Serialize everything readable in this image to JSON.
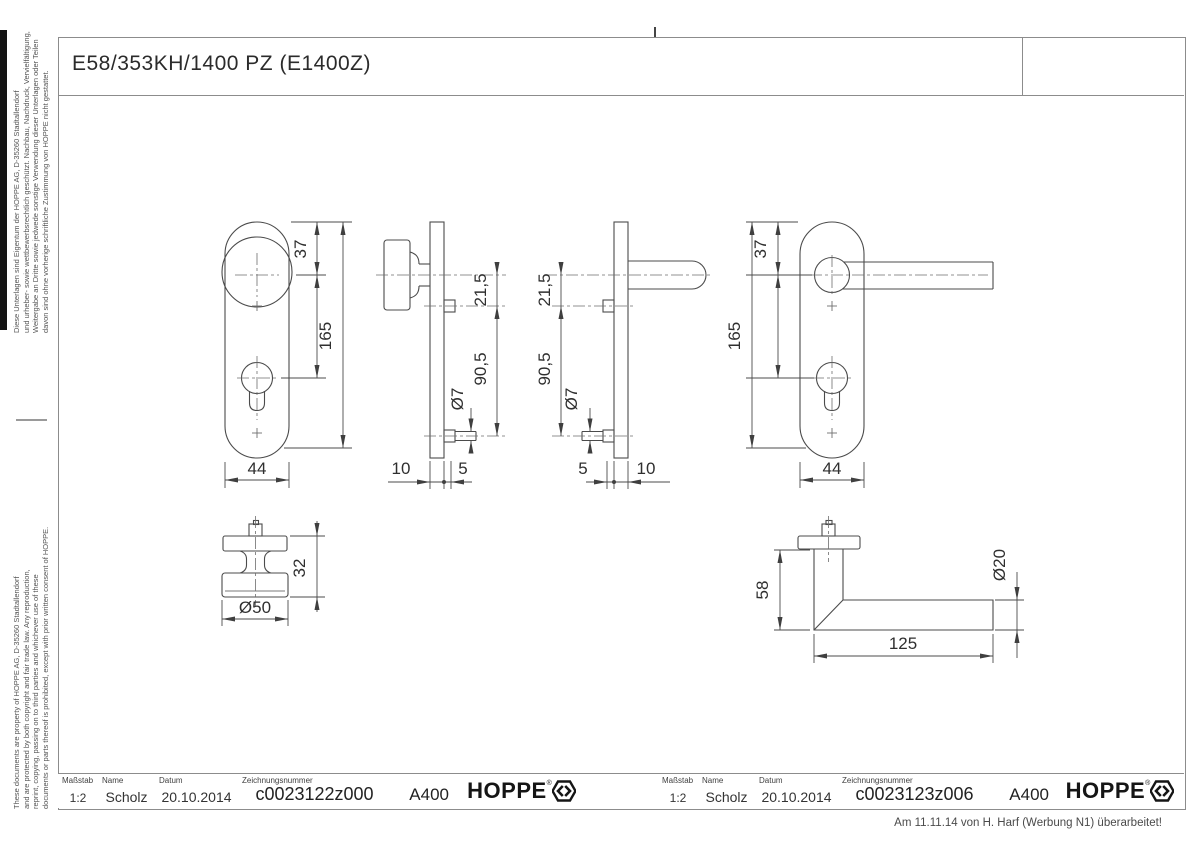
{
  "drawing_title": "E58/353KH/1400 PZ (E1400Z)",
  "legal_notice": {
    "german": [
      "Diese Unterlagen sind Eigentum der HOPPE AG, D-35260 Stadtallendorf",
      "und urheber- sowie wettbewerbsrechtlich geschützt. Nachbau, Nachdruck, Vervielfältigung,",
      "Weitergabe an Dritte sowie jedwede sonstige Verwendung dieser Unterlagen oder Teilen",
      "davon sind ohne vorherige schriftliche Zustimmung von HOPPE nicht gestattet."
    ],
    "english": [
      "These documents are property of HOPPE AG, D-35260 Stadtallendorf",
      "and are protected by both copyright and fair trade law. Any reproduction,",
      "reprint, copying, passing on to third parties and whichever use of these",
      "documents or parts thereof is prohibited, except with prior written consent of HOPPE."
    ]
  },
  "dimensions": {
    "knob_front": {
      "offset_top": "37",
      "length": "165",
      "width": "44"
    },
    "knob_side": {
      "axis_to_hole": "21,5",
      "hole_spacing": "90,5",
      "hole_dia": "Ø7",
      "knob_depth": "10",
      "nut_depth": "5"
    },
    "lever_side": {
      "axis_to_hole": "21,5",
      "hole_spacing": "90,5",
      "hole_dia": "Ø7",
      "nut_depth": "5",
      "plate_depth": "10"
    },
    "lever_front": {
      "offset_top": "37",
      "length": "165",
      "width": "44"
    },
    "knob_detail": {
      "height": "32",
      "diameter": "Ø50"
    },
    "lever_detail": {
      "height": "58",
      "grip_dia": "Ø20",
      "grip_length": "125"
    }
  },
  "title_blocks": [
    {
      "scale_label": "Maßstab",
      "scale": "1:2",
      "name_label": "Name",
      "name": "Scholz",
      "date_label": "Datum",
      "date": "20.10.2014",
      "number_label": "Zeichnungsnummer",
      "number": "c0023122z000",
      "code": "A400",
      "brand": "HOPPE",
      "reg": "®"
    },
    {
      "scale_label": "Maßstab",
      "scale": "1:2",
      "name_label": "Name",
      "name": "Scholz",
      "date_label": "Datum",
      "date": "20.10.2014",
      "number_label": "Zeichnungsnummer",
      "number": "c0023123z006",
      "code": "A400",
      "brand": "HOPPE",
      "reg": "®"
    }
  ],
  "revision_note": "Am 11.11.14 von H. Harf (Werbung N1) überarbeitet!",
  "colors": {
    "line": "#4b4b4b",
    "frame": "#8c8c8c",
    "centerline": "#6e6e6e"
  }
}
